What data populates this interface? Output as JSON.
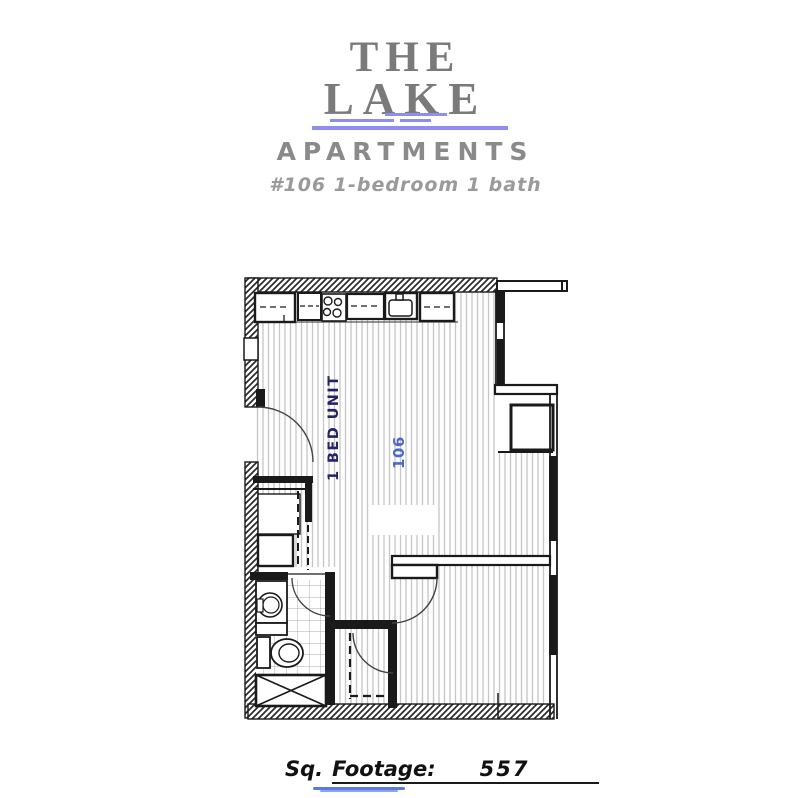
{
  "header": {
    "brand_line1": "THE",
    "brand_line2": "LAKE",
    "brand_word": "APARTMENTS",
    "unit_subtitle": "#106 1-bedroom 1 bath"
  },
  "floor_plan": {
    "unit_type_label": "1 BED UNIT",
    "room_number": "106"
  },
  "footer": {
    "label_prefix": "Sq.",
    "label": "Footage:",
    "value": "557"
  },
  "colors": {
    "brand_gray": "#7a7a7a",
    "subtitle_gray": "#9a9a9a",
    "accent_periwinkle": "#8d8df2",
    "unit_label_navy": "#232366",
    "room_number_blue": "#4c69c6",
    "squiggle_blue": "#5b79e3",
    "wall_black": "#1a1a1a",
    "floor_stripe_gray": "#c5c5ca"
  }
}
